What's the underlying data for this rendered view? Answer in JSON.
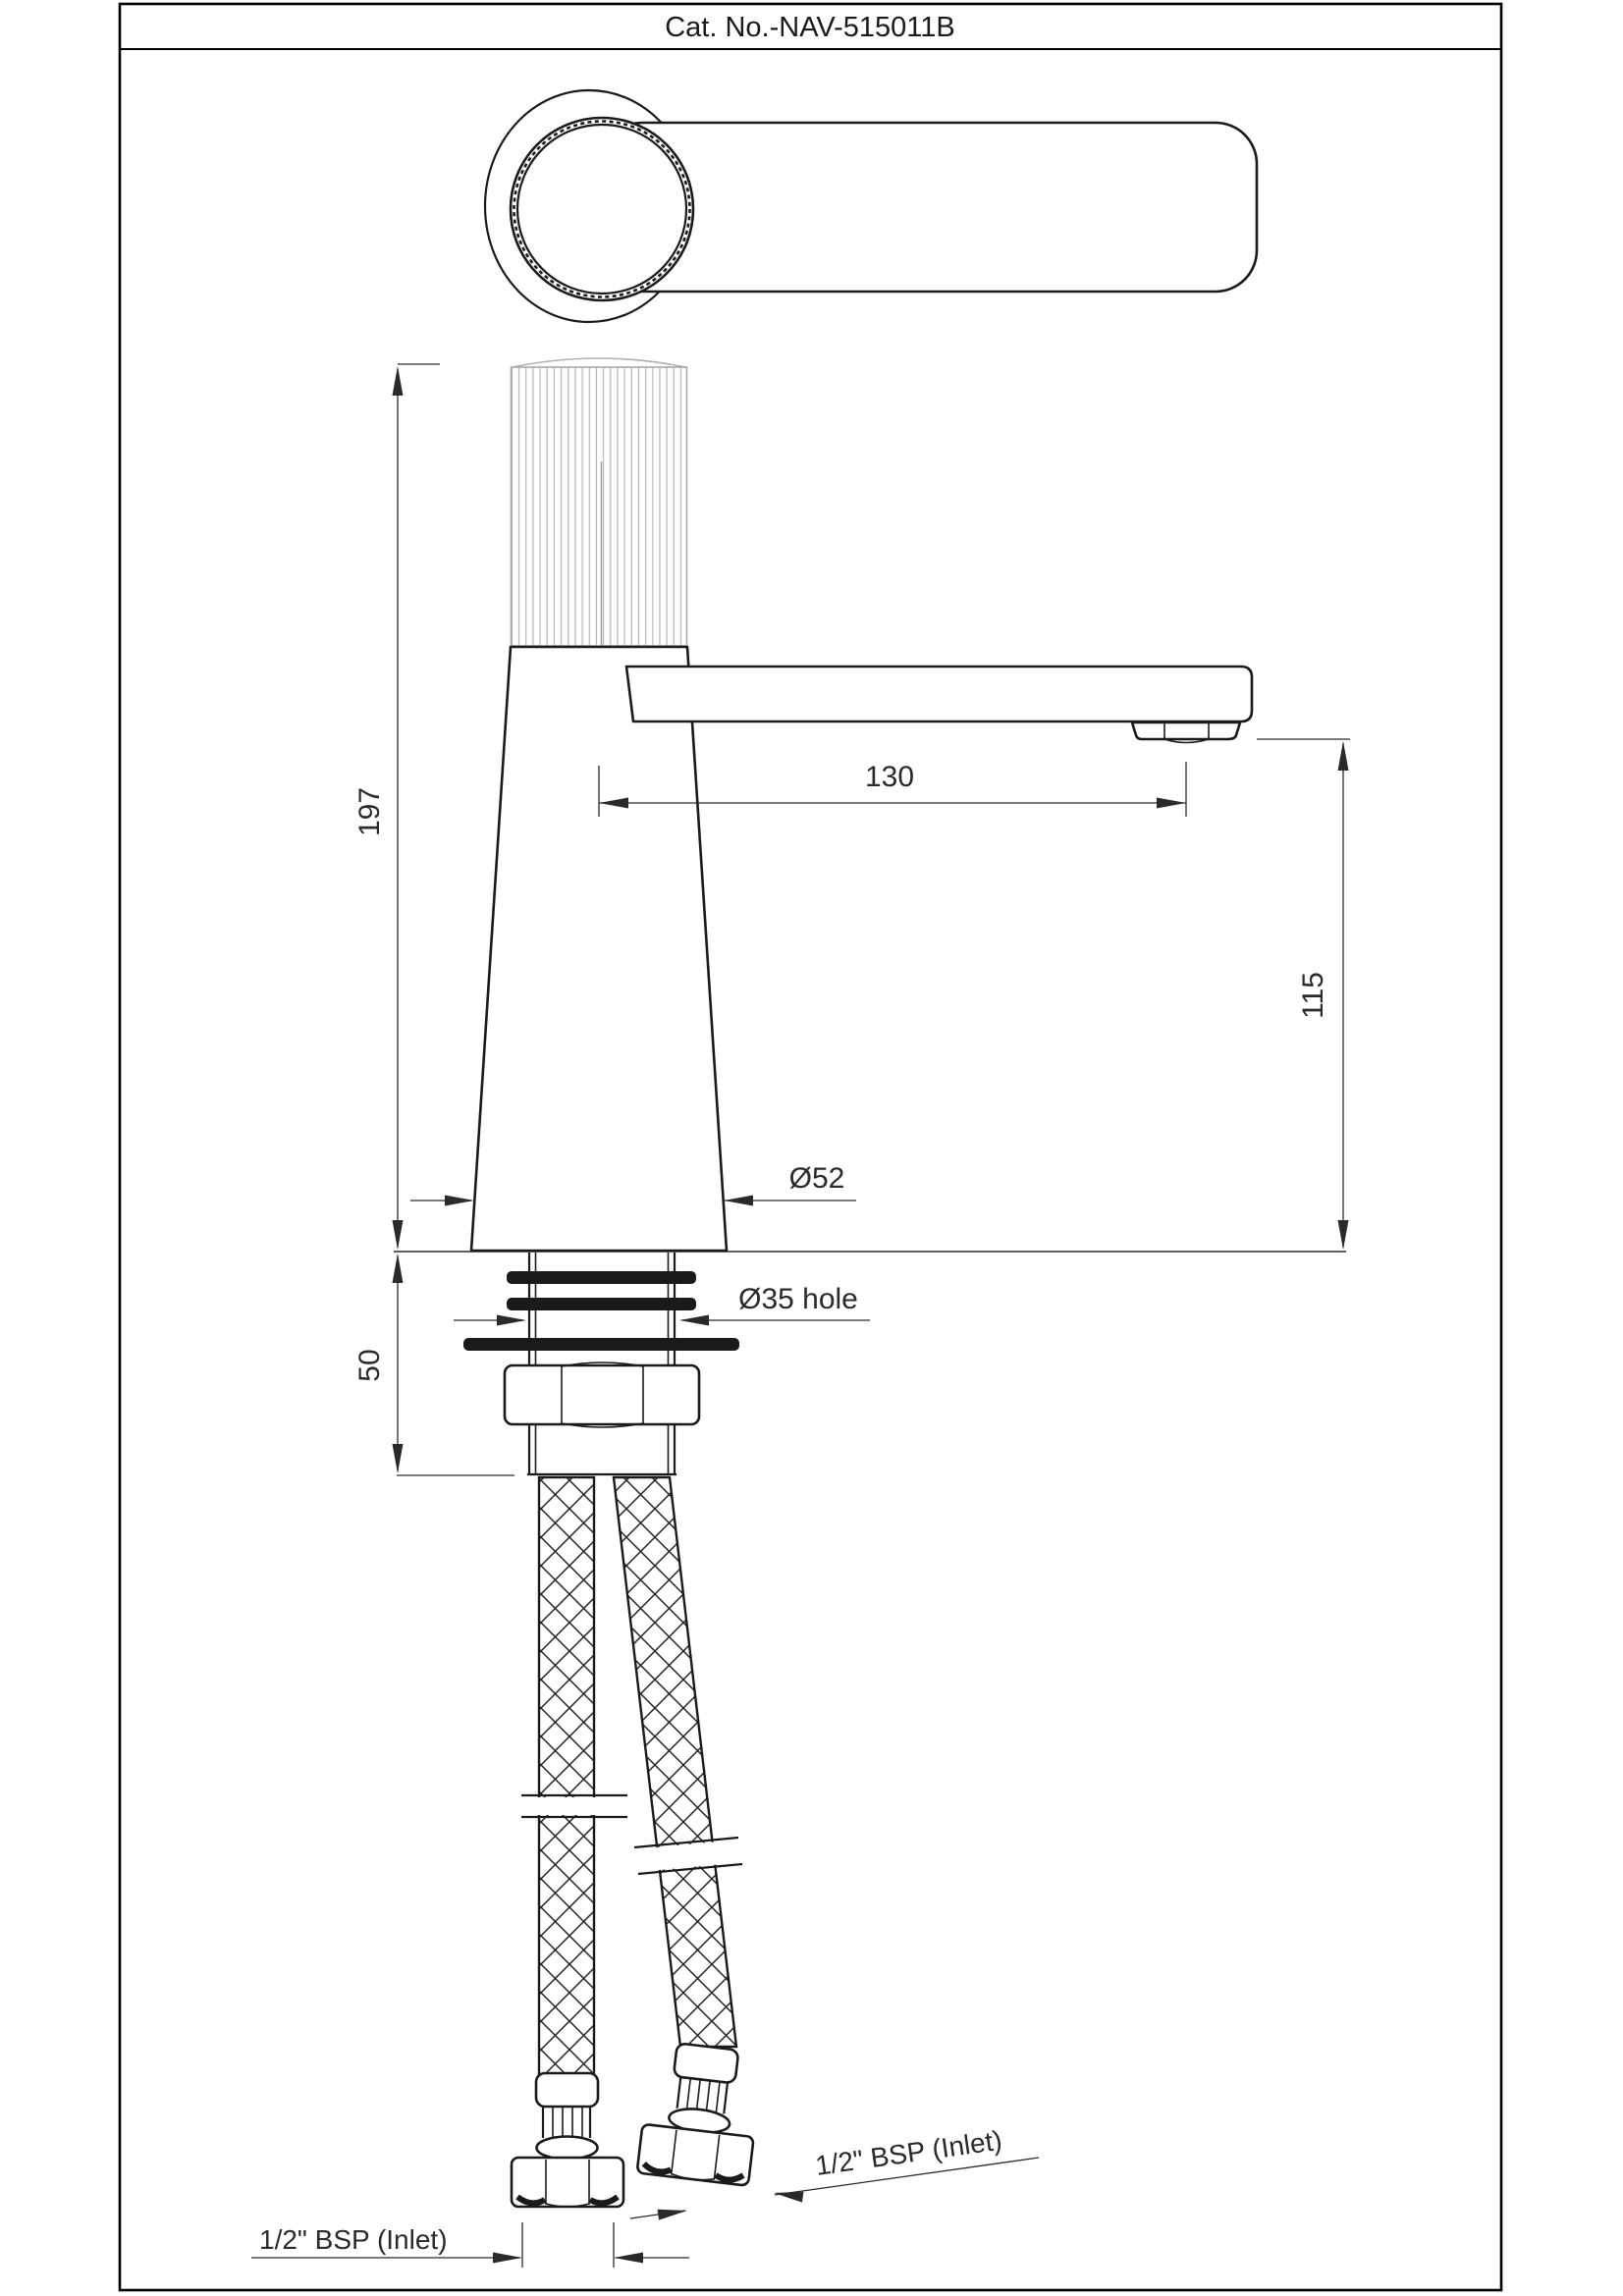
{
  "title": "Cat. No.-NAV-515011B",
  "drawing": {
    "type": "faucet technical drawing",
    "views": [
      "handle top view",
      "front elevation",
      "supply hoses"
    ]
  },
  "dimensions": {
    "total_height": "197",
    "base_depth": "50",
    "spout_reach": "130",
    "spout_height": "115",
    "body_diameter": "Ø52",
    "hole_diameter": "Ø35 hole",
    "inlet_left": "1/2\" BSP (Inlet)",
    "inlet_right": "1/2\" BSP (Inlet)"
  },
  "colors": {
    "line": "#1a1a1a",
    "dim": "#2a2a2a",
    "knurl": "#b0b0b0",
    "background": "#ffffff"
  }
}
